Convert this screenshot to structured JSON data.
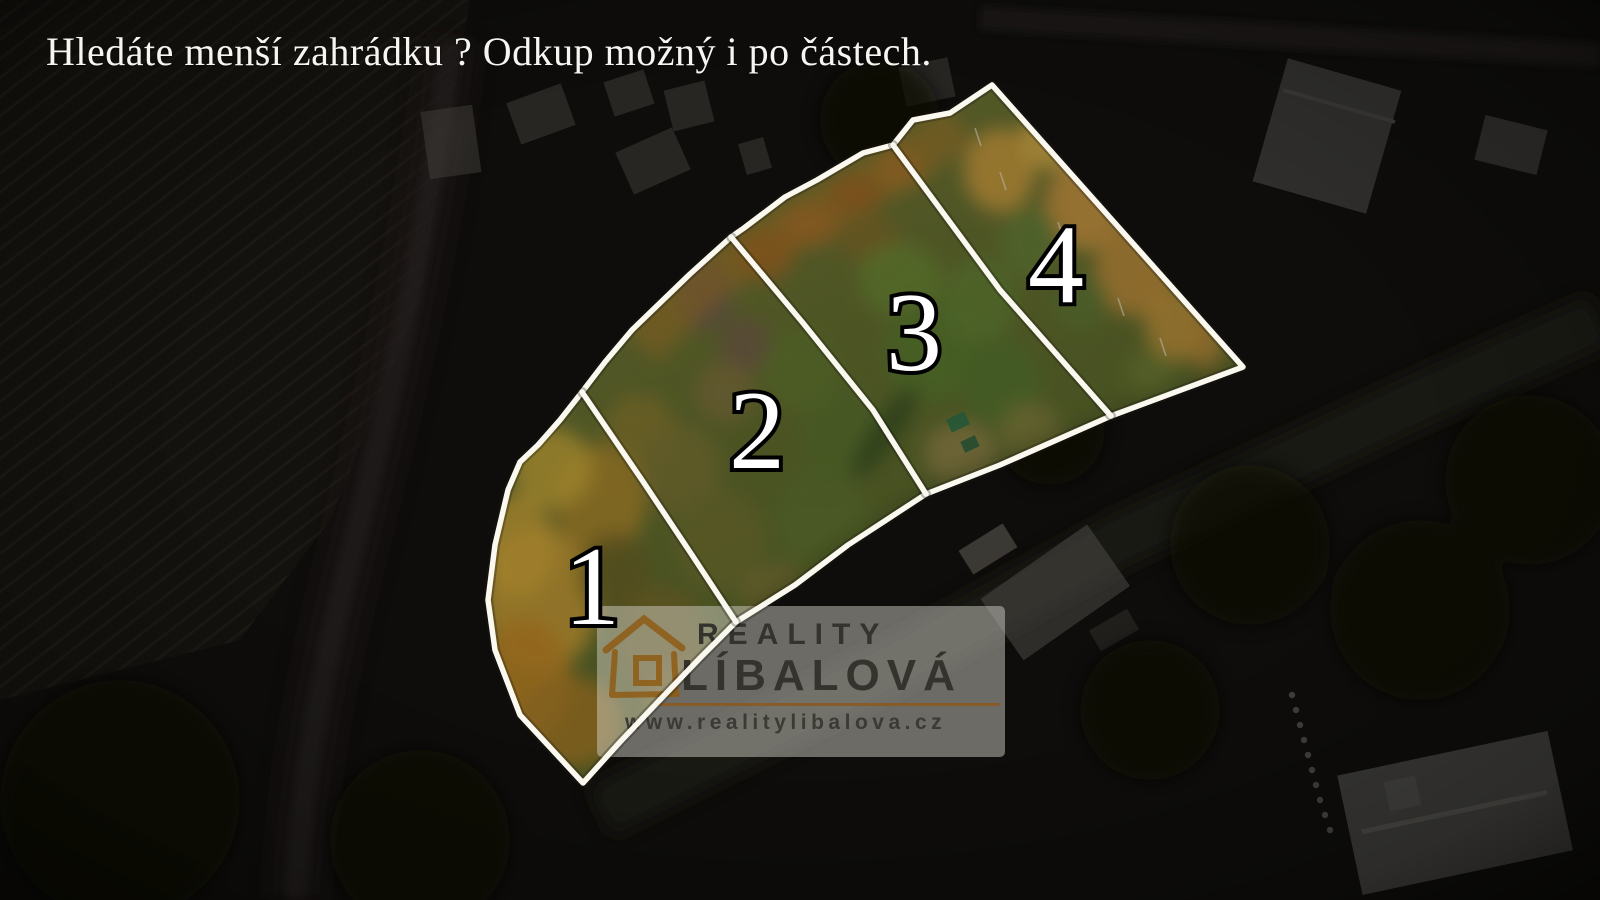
{
  "headline": {
    "text": "Hledáte menší zahrádku ? Odkup možný i po částech."
  },
  "plots": {
    "labels": [
      "1",
      "2",
      "3",
      "4"
    ]
  },
  "watermark": {
    "line1": "REALITY",
    "line2": "LÍBALOVÁ",
    "website": "www.realitylibalova.cz",
    "icon": "house-icon"
  },
  "colors": {
    "boundary_line": "#fbf9ef",
    "plot_number_fill": "#ffffff",
    "plot_number_outline": "#000000",
    "headline_text": "#f6f5f1",
    "watermark_panel": "rgba(213,211,203,0.48)",
    "watermark_text": "#34332e",
    "watermark_rule": "#8a5a22",
    "house_icon": "#8f5c14",
    "darkened_surround": "#0e0d0b",
    "parcel_meadow_green": "#5f6c2e",
    "parcel_autumn_orange": "#bd8425",
    "parcel_autumn_gold": "#c9973d"
  }
}
